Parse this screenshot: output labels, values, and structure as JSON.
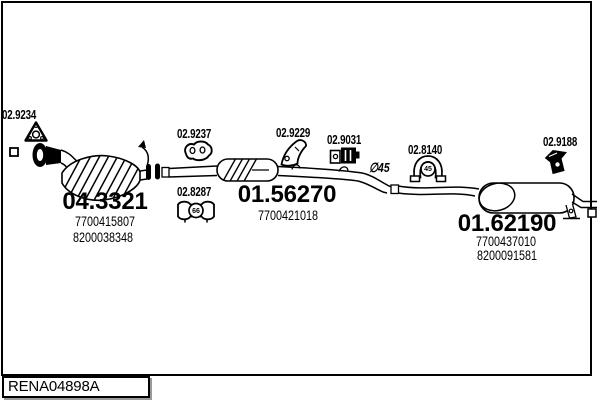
{
  "frame": {
    "code_label": "RENA04898A"
  },
  "annotations": {
    "pipe_diameter": "∅45"
  },
  "parts": {
    "gasket": {
      "code": "02.9234"
    },
    "front_hanger": {
      "code": "02.9237"
    },
    "clamp_66": {
      "code": "02.8287",
      "size": "66"
    },
    "mid_bracket": {
      "code": "02.9229"
    },
    "mid_mount": {
      "code": "02.9031"
    },
    "clamp_45": {
      "code": "02.8140",
      "size": "45"
    },
    "rear_bracket": {
      "code": "02.9188"
    },
    "catalyst": {
      "code": "04.3321",
      "oem1": "7700415807",
      "oem2": "8200038348"
    },
    "mid_muffler": {
      "code": "01.56270",
      "oem1": "7700421018"
    },
    "rear_muffler": {
      "code": "01.62190",
      "oem1": "7700437010",
      "oem2": "8200091581"
    }
  }
}
